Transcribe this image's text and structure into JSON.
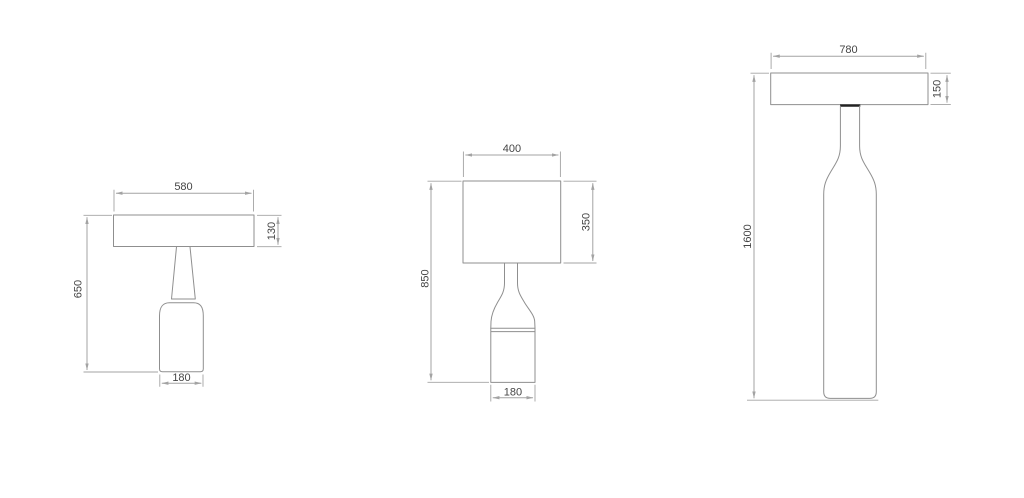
{
  "colors": {
    "background": "#ffffff",
    "object_line": "#8f8f8f",
    "dimension_line": "#a3a3a3",
    "text": "#454545",
    "joint_dark": "#222222"
  },
  "drawings": [
    {
      "id": "table-lamp-small",
      "dims": {
        "shade_width": "580",
        "shade_height": "130",
        "overall_height": "650",
        "base_width": "180"
      }
    },
    {
      "id": "table-lamp-medium",
      "dims": {
        "shade_width": "400",
        "shade_height": "350",
        "overall_height": "850",
        "base_width": "180"
      }
    },
    {
      "id": "floor-lamp",
      "dims": {
        "shade_width": "780",
        "shade_height": "150",
        "overall_height": "1600"
      }
    }
  ]
}
